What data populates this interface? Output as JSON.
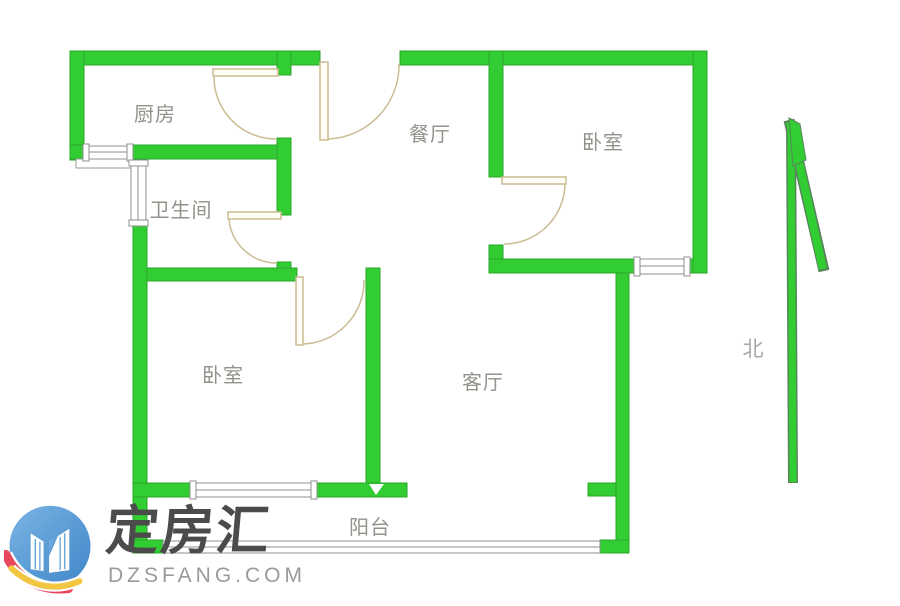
{
  "floorplan": {
    "rooms": [
      {
        "id": "kitchen",
        "label": "厨房"
      },
      {
        "id": "dining",
        "label": "餐厅"
      },
      {
        "id": "bedroom-north",
        "label": "卧室"
      },
      {
        "id": "bathroom",
        "label": "卫生间"
      },
      {
        "id": "bedroom-south",
        "label": "卧室"
      },
      {
        "id": "living",
        "label": "客厅"
      },
      {
        "id": "balcony",
        "label": "阳台"
      }
    ],
    "compass": {
      "label": "北"
    },
    "colors": {
      "wall": "#32cd32",
      "wall_edge": "#2aa52a",
      "door": "#cbbc92",
      "window_frame": "#8f8f8f",
      "room_label": "#8f948a",
      "compass_label": "#a8a8a8"
    }
  },
  "watermark": {
    "brand": "定房汇",
    "domain": "DZSFANG.COM",
    "colors": {
      "brand": "#4b4b4b",
      "domain": "#9a9a9a",
      "logo_blue": "#3f86c8",
      "logo_blue_light": "#7ab4e4",
      "logo_red": "#e8485e",
      "logo_yellow": "#f3c642"
    }
  }
}
